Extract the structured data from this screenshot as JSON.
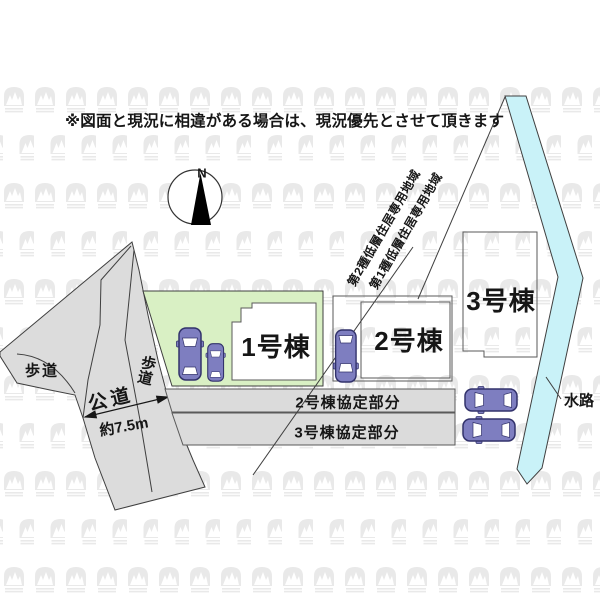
{
  "colors": {
    "road": "#dcdcdc",
    "lot_green": "#d9f0c4",
    "waterway": "#c9f2f8",
    "agreement_band": "#dbdbdb",
    "car_body": "#7e7ec0",
    "car_outline": "#32326b",
    "line": "#3f3f3f",
    "watermark": "#e9e9e9",
    "building_fill": "#ffffff"
  },
  "notes": {
    "disclaimer": "※図面と現況に相違がある場合は、現況優先とさせて頂きます"
  },
  "compass": {
    "north": "N"
  },
  "zones": [
    {
      "label": "第2種低層住居専用地域"
    },
    {
      "label": "第1種低層住居専用地域"
    }
  ],
  "buildings": [
    {
      "label": "1号棟"
    },
    {
      "label": "2号棟"
    },
    {
      "label": "3号棟"
    }
  ],
  "roads": {
    "public_road": "公道",
    "width": "約7.5m",
    "sidewalk_left": "歩道",
    "sidewalk_right": "歩道"
  },
  "agreement_areas": [
    {
      "label": "2号棟協定部分"
    },
    {
      "label": "3号棟協定部分"
    }
  ],
  "waterway": {
    "label": "水路"
  }
}
